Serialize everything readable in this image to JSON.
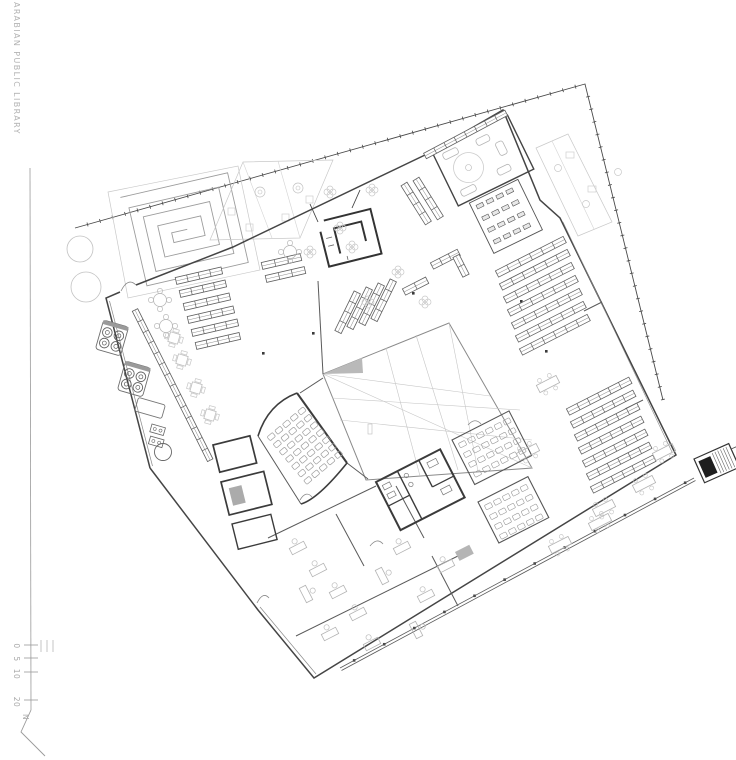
{
  "sheet": {
    "title": "ARABIAN PUBLIC LIBRARY",
    "north_label": "N",
    "scale_bar": {
      "labels": [
        "0",
        "5",
        "10",
        "20"
      ]
    }
  }
}
